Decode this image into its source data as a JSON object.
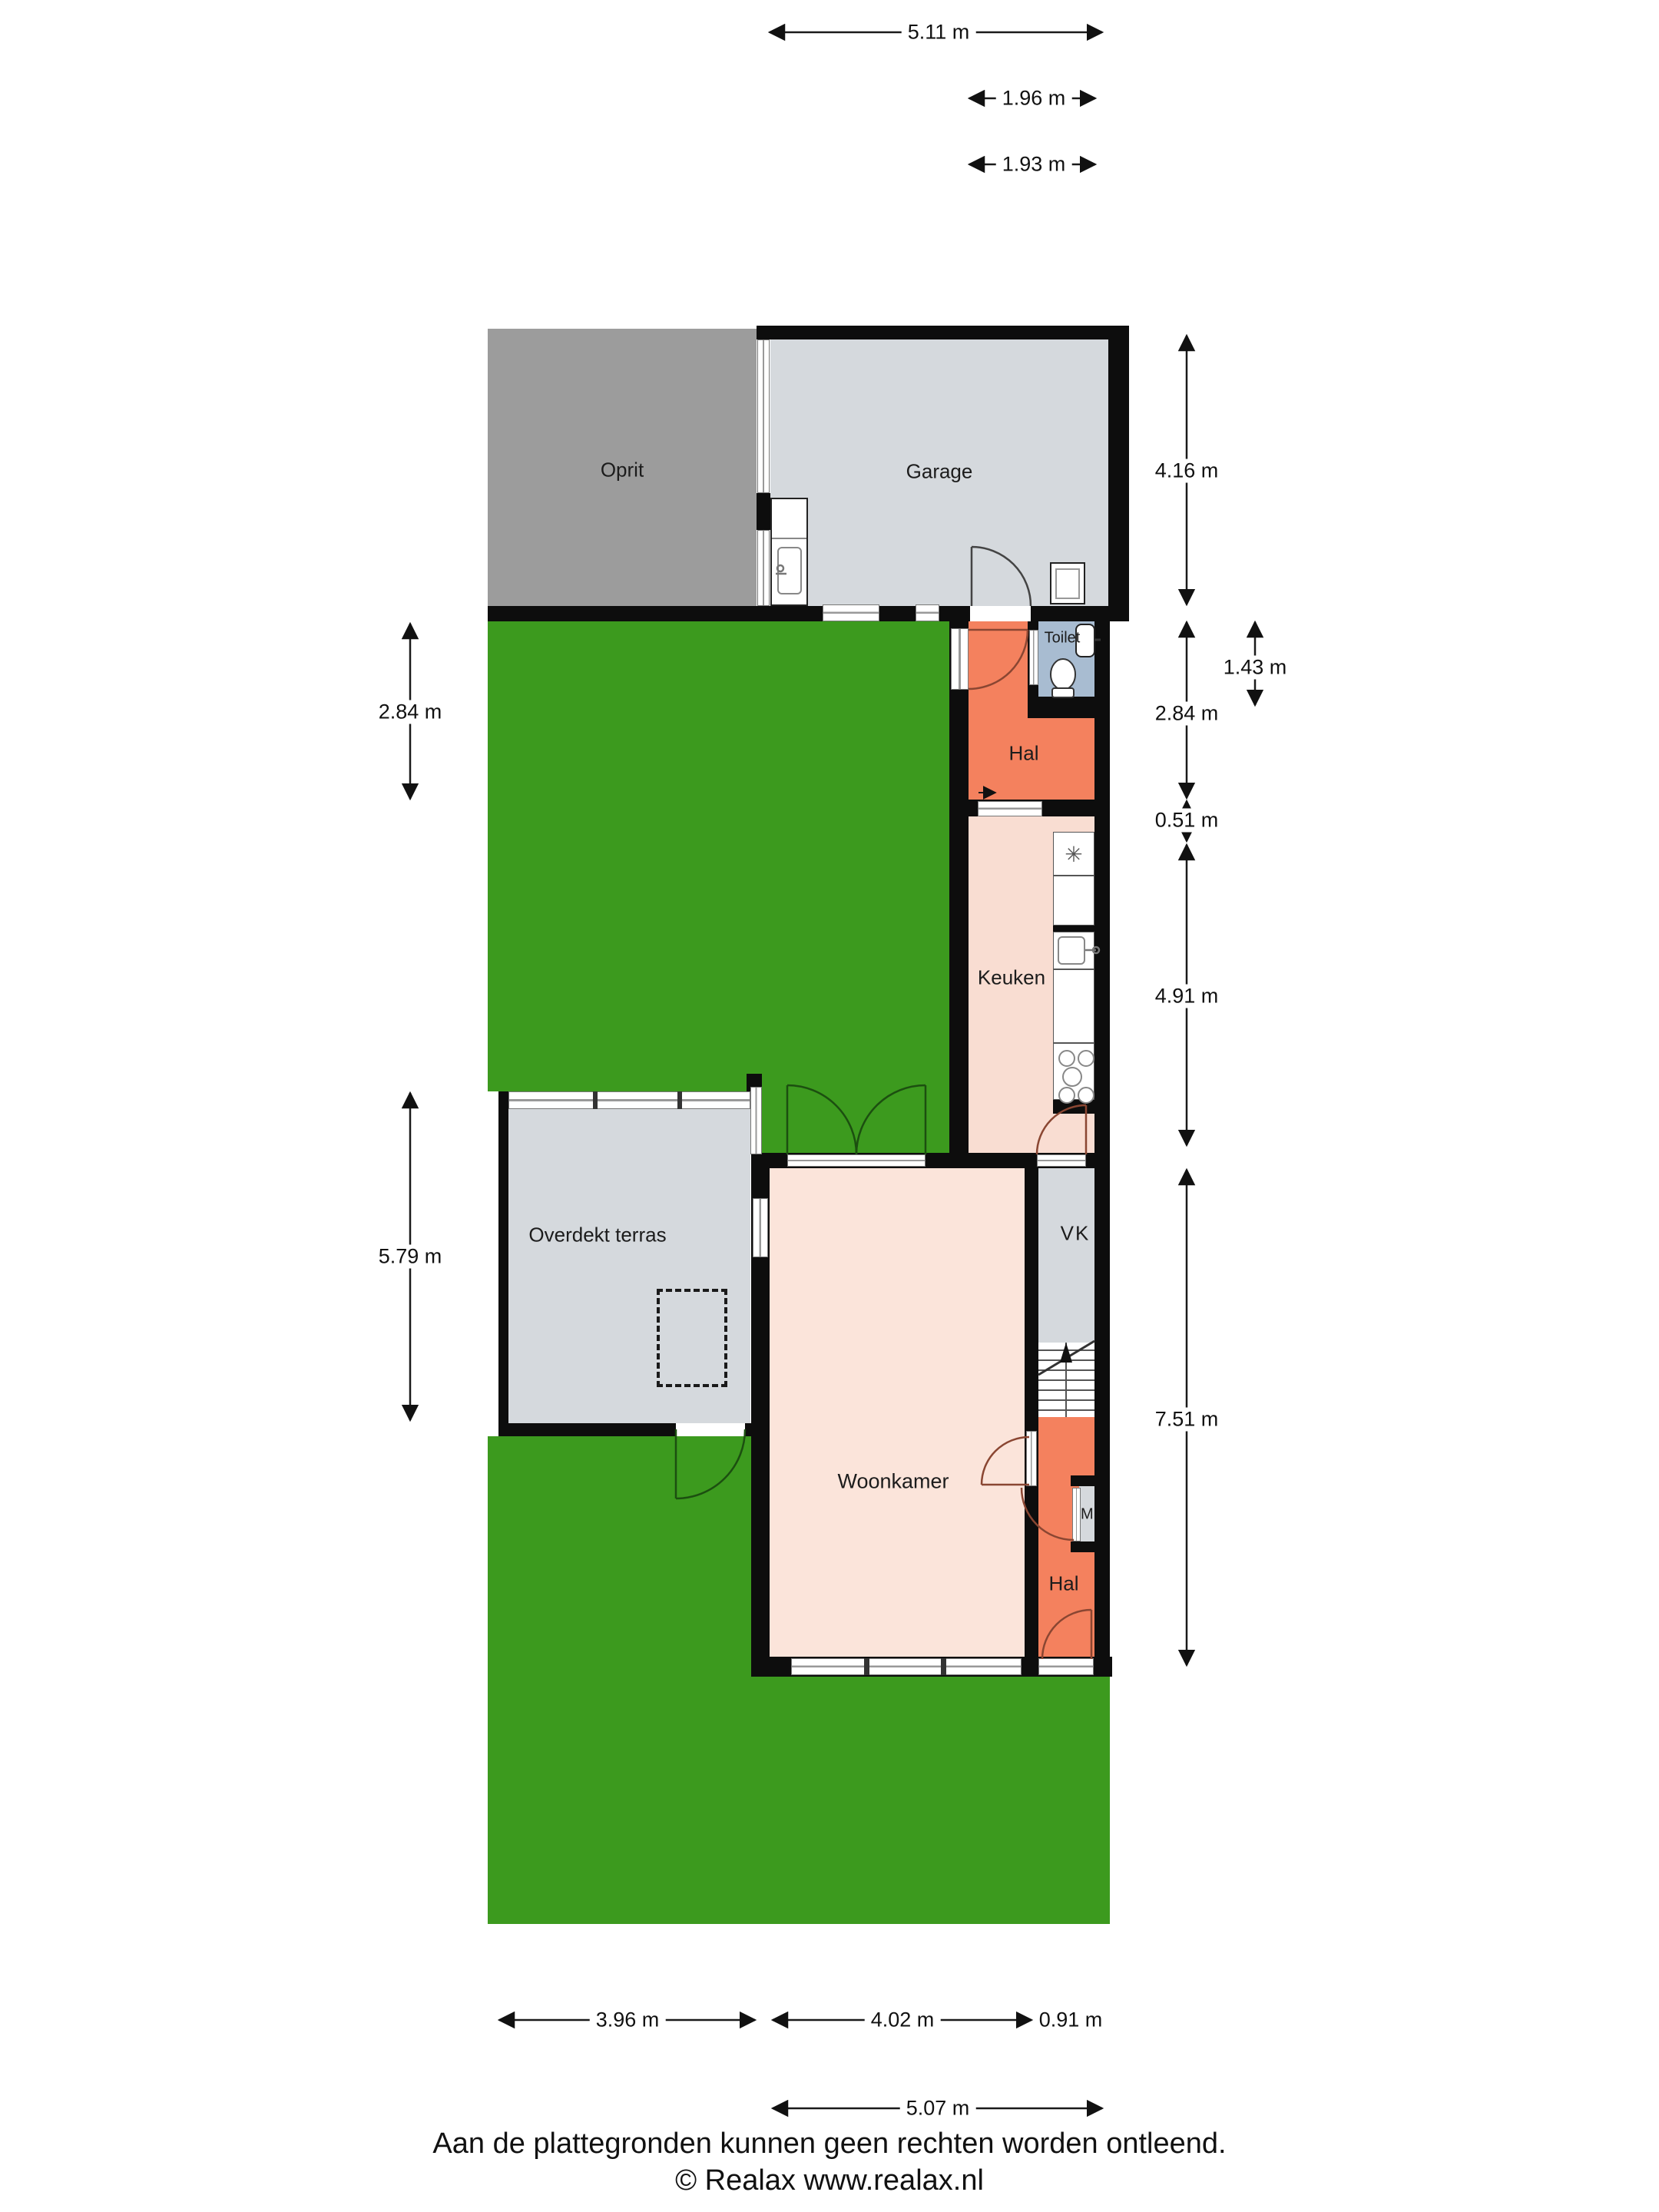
{
  "rooms": {
    "oprit": {
      "label": "Oprit"
    },
    "garage": {
      "label": "Garage"
    },
    "toilet": {
      "label": "Toilet"
    },
    "hal_top": {
      "label": "Hal"
    },
    "keuken": {
      "label": "Keuken"
    },
    "terras": {
      "label": "Overdekt terras"
    },
    "woonkamer": {
      "label": "Woonkamer"
    },
    "vk": {
      "label": "VK"
    },
    "mk": {
      "label": "MK"
    },
    "hal_bottom": {
      "label": "Hal"
    }
  },
  "dims": {
    "top_511": "5.11 m",
    "top_196": "1.96 m",
    "top_193": "1.93 m",
    "right_416": "4.16 m",
    "right_284": "2.84 m",
    "right_143": "1.43 m",
    "right_051": "0.51 m",
    "right_491": "4.91 m",
    "right_751": "7.51 m",
    "left_284": "2.84 m",
    "left_579": "5.79 m",
    "bottom_396": "3.96 m",
    "bottom_402": "4.02 m",
    "bottom_091": "0.91 m",
    "bottom_507": "5.07 m"
  },
  "icons": {
    "fridge_vent": "✳"
  },
  "footer": {
    "disclaimer": "Aan de plattegronden kunnen geen rechten worden ontleend.",
    "copyright": "© Realax www.realax.nl"
  },
  "colors": {
    "garden_green": "#3c9a1e",
    "driveway_gray": "#9c9c9c",
    "interior_gray": "#d5d9dd",
    "toilet_blue": "#a8bcd1",
    "hall_orange": "#f4815e",
    "living_pink": "#fbe4da",
    "kitchen_pink": "#f9ddd2",
    "wall_black": "#0d0d0d"
  }
}
